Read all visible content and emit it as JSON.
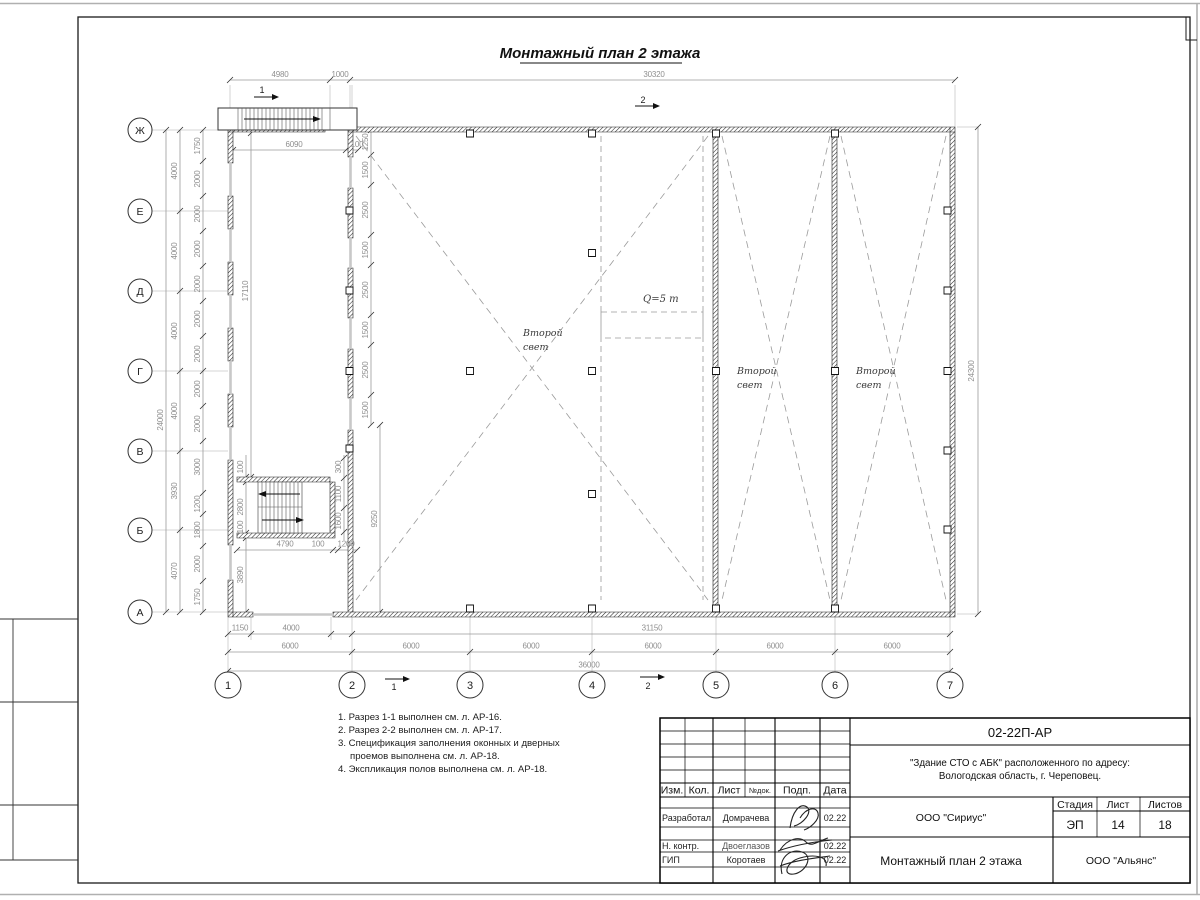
{
  "sheet_title": "Монтажный план 2 этажа",
  "axes": {
    "letters": [
      "Ж",
      "Е",
      "Д",
      "Г",
      "В",
      "Б",
      "А"
    ],
    "numbers": [
      "1",
      "2",
      "3",
      "4",
      "5",
      "6",
      "7"
    ]
  },
  "sections": {
    "s1": "1",
    "s2": "2"
  },
  "hall_labels": {
    "second_light_word1": "Второй",
    "second_light_word2": "свет",
    "crane": "Q=5 т"
  },
  "dims": {
    "top": [
      "4980",
      "1000",
      "30320"
    ],
    "annex": [
      "6090",
      "100"
    ],
    "left_total": "24000",
    "left_axes": [
      "4000",
      "4000",
      "4000",
      "4000",
      "3930",
      "4070"
    ],
    "left_inner": [
      "1750",
      "2000",
      "2000",
      "2000",
      "2000",
      "2000",
      "2000",
      "2000",
      "2000",
      "3000",
      "1200",
      "1800",
      "2000",
      "1750"
    ],
    "inner_wall": [
      "1250",
      "1500",
      "2500",
      "1500",
      "2500",
      "1500",
      "2500",
      "1500"
    ],
    "block_inner": [
      "17110",
      "9250"
    ],
    "stair_left": [
      "100",
      "2800",
      "100",
      "3890"
    ],
    "stair_right": [
      "300",
      "1100",
      "1600"
    ],
    "stair_bottom": [
      "4790",
      "100",
      "1200"
    ],
    "right_total": "24300",
    "bottom_row1": [
      "1150",
      "4000",
      "31150"
    ],
    "bottom_row2": [
      "6000",
      "6000",
      "6000",
      "6000",
      "6000",
      "6000"
    ],
    "bottom_row3": "36000"
  },
  "notes": {
    "lines": [
      "1. Разрез 1-1 выполнен см. л. АР-16.",
      "2. Разрез 2-2 выполнен см. л. АР-17.",
      "3. Спецификация заполнения оконных и дверных",
      "проемов выполнена см. л. АР-18.",
      "4. Экспликация полов выполнена см. л. АР-18."
    ]
  },
  "titleblock": {
    "doc_number": "02-22П-АР",
    "object_line1": "\"Здание СТО с АБК\" расположенного по адресу:",
    "object_line2": "Вологодская область, г. Череповец.",
    "header": [
      "Изм.",
      "Кол.",
      "Лист",
      "№док.",
      "Подп.",
      "Дата"
    ],
    "rows": [
      {
        "role": "Разработал",
        "name": "Домрачева",
        "date": "02.22"
      },
      {
        "role": "Н. контр.",
        "name": "Двоеглазов",
        "date": "02.22"
      },
      {
        "role": "ГИП",
        "name": "Коротаев",
        "date": "02.22"
      }
    ],
    "designer_org": "ООО \"Сириус\"",
    "drawing_name": "Монтажный план 2 этажа",
    "owner_org": "ООО \"Альянс\"",
    "stage_label": "Стадия",
    "sheet_label": "Лист",
    "sheets_label": "Листов",
    "stage": "ЭП",
    "sheet_no": "14",
    "sheets_total": "18"
  },
  "colors": {
    "line": "#1c1c1c",
    "dim_text": "#8f8f8f",
    "dashed": "#9a9a9a",
    "accent": "#000000"
  }
}
